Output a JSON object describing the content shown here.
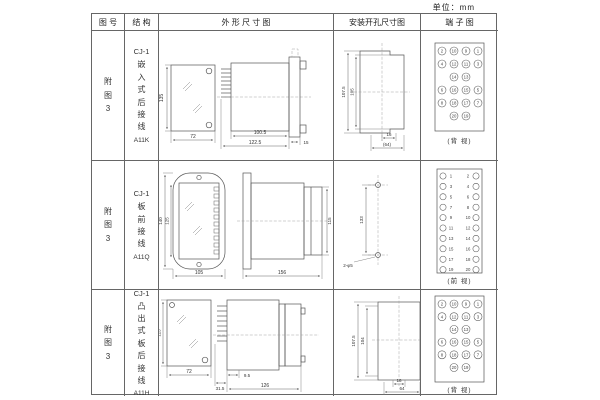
{
  "unit_label": "单位：mm",
  "table": {
    "headers": [
      "图 号",
      "结 构",
      "外 形 尺 寸 图",
      "安装开孔尺寸图",
      "端 子 图"
    ]
  },
  "rows": [
    {
      "fig_no": "附图3",
      "model": "CJ-1",
      "desc": "嵌入式后接线",
      "code": "A11K",
      "outline_dims": {
        "height": "135",
        "width": "72",
        "body": "100.5",
        "total": "122.5",
        "flange": "15"
      },
      "install_dims": {
        "outer": "107.5",
        "inner": "105",
        "slot": "16",
        "width": "(64)"
      },
      "terminal": {
        "caption": "(背 视)",
        "rows": [
          [
            "2",
            "10",
            "9",
            "1"
          ],
          [
            "4",
            "12",
            "11",
            "3"
          ],
          [
            "14",
            "13"
          ],
          [
            "6",
            "16",
            "15",
            "5"
          ],
          [
            "8",
            "18",
            "17",
            "7"
          ],
          [
            "20",
            "19"
          ]
        ]
      }
    },
    {
      "fig_no": "附图3",
      "model": "CJ-1",
      "desc": "板前接线",
      "code": "A11Q",
      "outline_dims": {
        "outer_h": "140",
        "inner_h": "125",
        "width": "105",
        "length": "156",
        "side_h": "115"
      },
      "install_dims": {
        "span": "133",
        "holes": "2-φ5"
      },
      "terminal": {
        "caption": "(前 视)",
        "left": [
          "1",
          "3",
          "5",
          "7",
          "9",
          "11",
          "13",
          "15",
          "17",
          "19"
        ],
        "right": [
          "2",
          "4",
          "6",
          "8",
          "10",
          "12",
          "14",
          "16",
          "18",
          "20"
        ]
      }
    },
    {
      "fig_no": "附图3",
      "model": "CJ-1",
      "desc": "凸出式板后接线",
      "code": "A11H",
      "outline_dims": {
        "height": "113",
        "width": "72",
        "pins": "31.5",
        "offset": "9.5",
        "total": "126"
      },
      "install_dims": {
        "outer": "107.5",
        "inner": "104",
        "slot": "16",
        "width": "64"
      },
      "terminal": {
        "caption": "(背 视)",
        "rows": [
          [
            "2",
            "10",
            "9",
            "1"
          ],
          [
            "4",
            "12",
            "11",
            "3"
          ],
          [
            "14",
            "13"
          ],
          [
            "6",
            "16",
            "15",
            "5"
          ],
          [
            "8",
            "18",
            "17",
            "7"
          ],
          [
            "20",
            "19"
          ]
        ]
      }
    }
  ]
}
